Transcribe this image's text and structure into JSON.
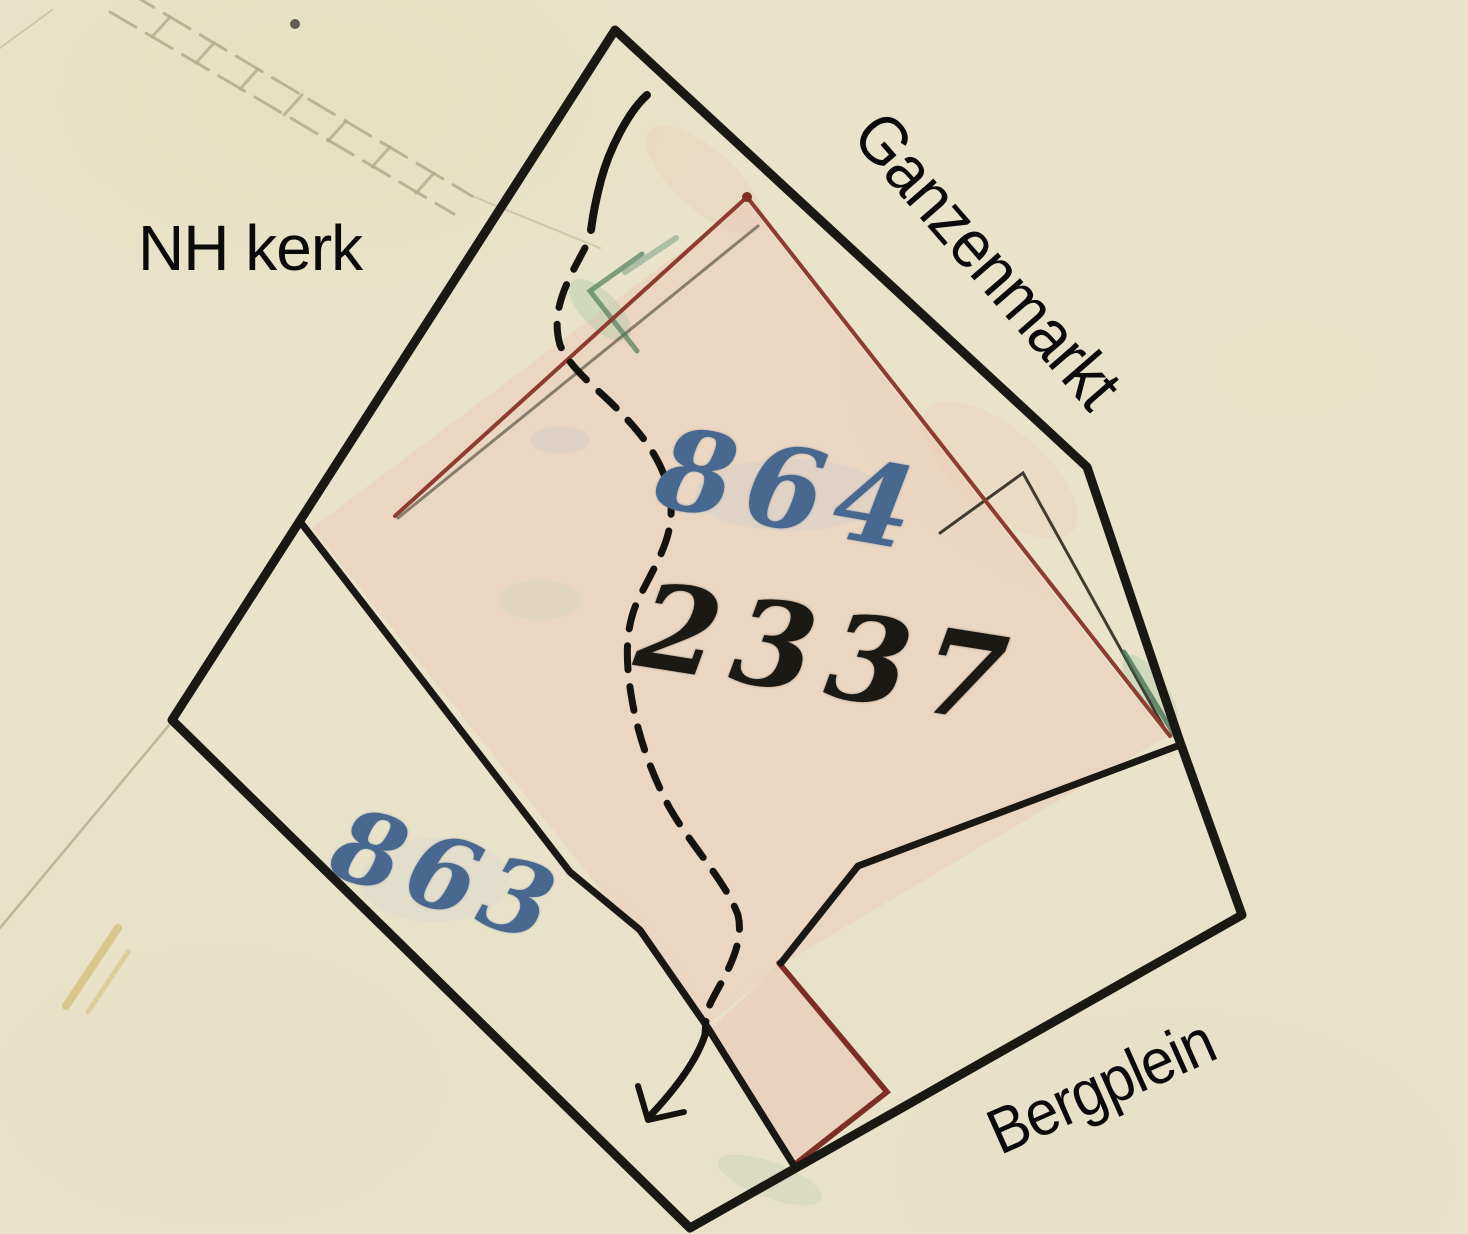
{
  "street_labels": {
    "nh_kerk": "NH kerk",
    "ganzenmarkt": "Ganzenmarkt",
    "bergplein": "Bergplein"
  },
  "parcel_numbers": {
    "p864": "864",
    "p2337": "2337",
    "p863": "863"
  },
  "colors": {
    "paper": "#e9e3ca",
    "boundary_ink": "#1a1812",
    "red_ink": "#8e3c30",
    "dark_red_ink": "#7d2f26",
    "blue_ink": "#49688f",
    "green_pencil": "#4f7d5a",
    "pink_wash": "#ecc9b8",
    "faint_line": "#b2ab8c",
    "yellow_pencil": "#c7a33e"
  }
}
